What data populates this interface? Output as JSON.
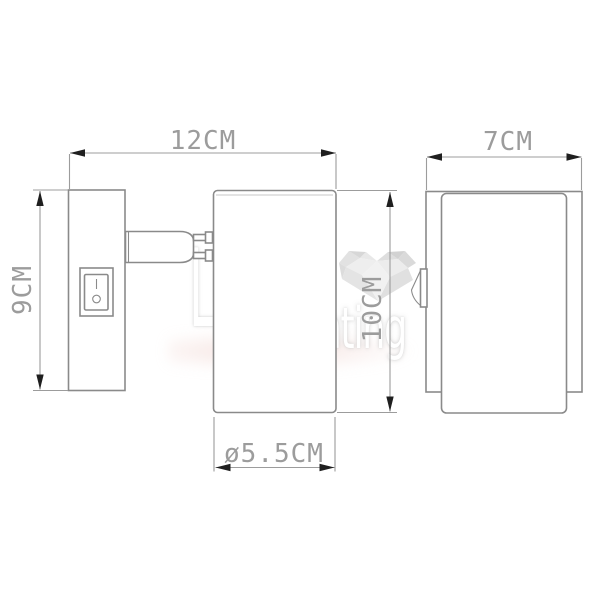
{
  "diagram": {
    "kind": "wall-spotlight dimension drawing",
    "views": {
      "side_view": "wall plate with rocker switch, arm and cylindrical spot head",
      "front_view": "back plate with cylindrical body and side switch lever"
    },
    "dimensions": {
      "total_projection": "12CM",
      "plate_height": "9CM",
      "body_height": "10CM",
      "plate_width": "7CM",
      "body_diameter": "ø5.5CM"
    },
    "colors": {
      "outline": "#8a8a8a",
      "dimension_line": "#9c9c9c",
      "dimension_text": "#9c9c9c",
      "arrowhead": "#1f1f1f",
      "watermark_gem": "#dfdfdf",
      "background": "#ffffff"
    }
  },
  "watermark": {
    "brand_top": "LOVE",
    "brand_bottom": "lighting"
  }
}
